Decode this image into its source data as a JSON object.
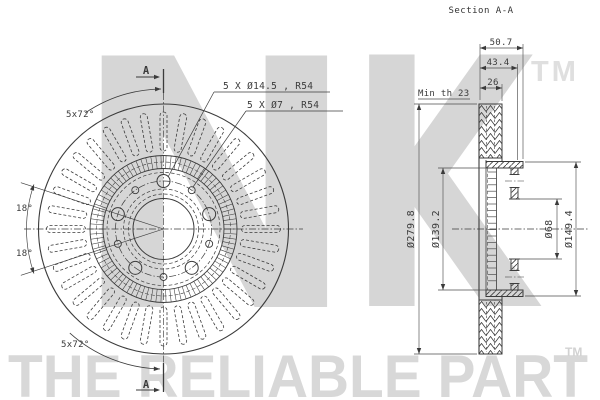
{
  "section_view": {
    "title": "Section A-A",
    "dims": {
      "width": "50.7",
      "hat_depth": "43.4",
      "thickness": "26",
      "min_th": "Min th 23",
      "outer_dia": "Ø279.8",
      "ring_dia": "Ø139.2",
      "bore_dia": "Ø68",
      "hat_dia": "Ø149.4"
    }
  },
  "front_view": {
    "labels": {
      "large_holes": "5 X Ø14.5 , R54",
      "small_holes": "5 X Ø7 , R54",
      "spacing_top": "5x72°",
      "spacing_bottom": "5x72°",
      "angle_upper": "18°",
      "angle_lower": "18°",
      "marker": "A"
    }
  },
  "watermark": {
    "letter_n": "N",
    "letter_k": "K",
    "tm": "TM",
    "slogan": "THE RELIABLE PART",
    "slogan_tm": "TM"
  },
  "colors": {
    "line": "#3b3b3b",
    "dim_line": "#4d4d4d",
    "watermark": "#d6d6d6",
    "watermark_tm": "#dfdfdf",
    "slogan": "#d8d8d8",
    "slogan_tm": "#d2d2d2",
    "background": "#ffffff"
  }
}
